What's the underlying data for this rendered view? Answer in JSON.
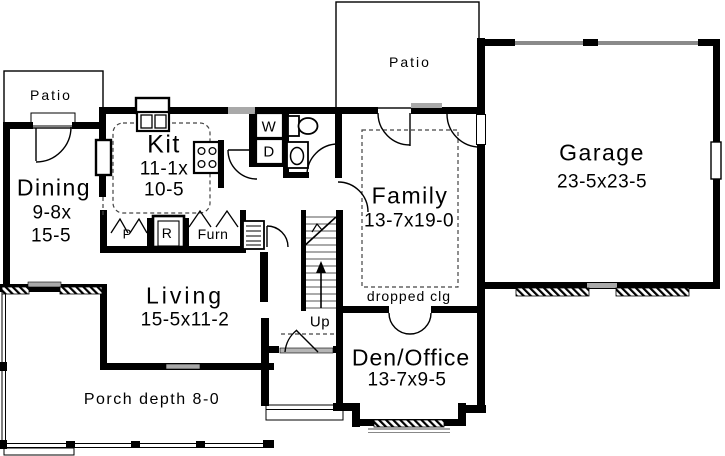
{
  "colors": {
    "wall": "#000000",
    "sill_gray": "#a9a9a9",
    "background": "#ffffff"
  },
  "rooms": {
    "patio_left": {
      "label": "Patio"
    },
    "patio_top": {
      "label": "Patio"
    },
    "dining": {
      "label": "Dining",
      "dim1": "9-8x",
      "dim2": "15-5"
    },
    "kitchen": {
      "label": "Kit",
      "dim1": "11-1x",
      "dim2": "10-5"
    },
    "family": {
      "label": "Family",
      "dim": "13-7x19-0"
    },
    "garage": {
      "label": "Garage",
      "dim": "23-5x23-5"
    },
    "living": {
      "label": "Living",
      "dim": "15-5x11-2"
    },
    "den": {
      "label": "Den/Office",
      "dim": "13-7x9-5"
    },
    "porch": {
      "label": "Porch depth 8-0"
    }
  },
  "fixtures": {
    "washer": "W",
    "dryer": "D",
    "pantry": "P",
    "refrigerator_closet": "R",
    "furnace": "Furn"
  },
  "annotations": {
    "stairs_up": "Up",
    "dropped_ceiling": "dropped clg"
  }
}
